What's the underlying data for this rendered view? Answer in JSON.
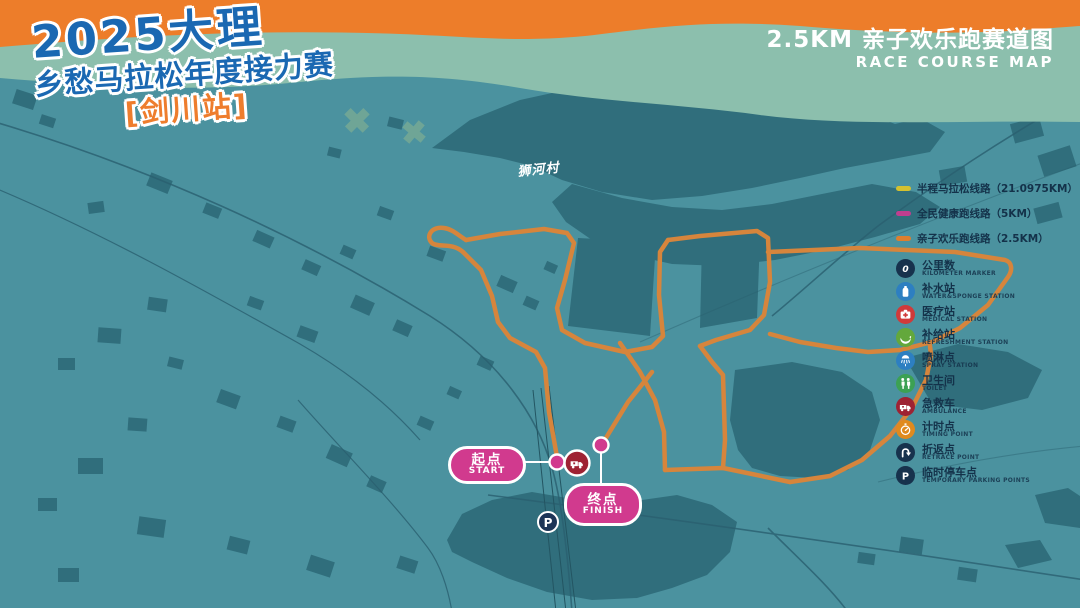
{
  "header": {
    "title_line1": "2025大理",
    "title_line2": "乡愁马拉松年度接力赛",
    "title_line3": "[剑川站]",
    "right_title_cn": "2.5KM 亲子欢乐跑赛道图",
    "right_title_en": "RACE COURSE MAP"
  },
  "map": {
    "village_label": "狮河村",
    "start": {
      "label_cn": "起点",
      "label_en": "START"
    },
    "finish": {
      "label_cn": "终点",
      "label_en": "FINISH"
    },
    "point_icons": [
      "ambulance-icon",
      "parking-icon",
      "start-dot",
      "finish-dot"
    ]
  },
  "legend": {
    "routes": [
      {
        "label": "半程马拉松线路（21.0975KM）",
        "color": "#d4c12f"
      },
      {
        "label": "全民健康跑线路（5KM）",
        "color": "#bf3e8f"
      },
      {
        "label": "亲子欢乐跑线路（2.5KM）",
        "color": "#dd7f2e"
      }
    ],
    "icons": [
      {
        "name": "kilometer-marker-icon",
        "label_cn": "公里数",
        "label_en": "KILOMETER MARKER",
        "color": "#17324d",
        "glyph_text": "0"
      },
      {
        "name": "water-station-icon",
        "label_cn": "补水站",
        "label_en": "WATER&SPONGE STATION",
        "color": "#2d7fc1"
      },
      {
        "name": "medical-station-icon",
        "label_cn": "医疗站",
        "label_en": "MEDICAL STATION",
        "color": "#d03a3a"
      },
      {
        "name": "refreshment-station-icon",
        "label_cn": "补给站",
        "label_en": "REFRESHMENT STATION",
        "color": "#63a83c"
      },
      {
        "name": "spray-station-icon",
        "label_cn": "喷淋点",
        "label_en": "SPRAY STATION",
        "color": "#2d7fc1"
      },
      {
        "name": "toilet-icon",
        "label_cn": "卫生间",
        "label_en": "TOILET",
        "color": "#3ca153"
      },
      {
        "name": "ambulance-icon",
        "label_cn": "急救车",
        "label_en": "AMBULANCE",
        "color": "#9e2233"
      },
      {
        "name": "timing-point-icon",
        "label_cn": "计时点",
        "label_en": "TIMING POINT",
        "color": "#e08a1e"
      },
      {
        "name": "retrace-point-icon",
        "label_cn": "折返点",
        "label_en": "RETRACE POINT",
        "color": "#17324d"
      },
      {
        "name": "parking-icon",
        "label_cn": "临时停车点",
        "label_en": "TEMPORARY PARKING POINTS",
        "color": "#17324d",
        "glyph_text": "P"
      }
    ]
  },
  "colors": {
    "header_orange": "#ed7d2a",
    "band_sage": "#8cbfad",
    "map_background": "#4b929f",
    "building": "#306e7c",
    "road": "#2a6070",
    "course_orange": "#d6853c",
    "pill_pink": "#d13a8e",
    "legend_navy": "#14324a"
  }
}
